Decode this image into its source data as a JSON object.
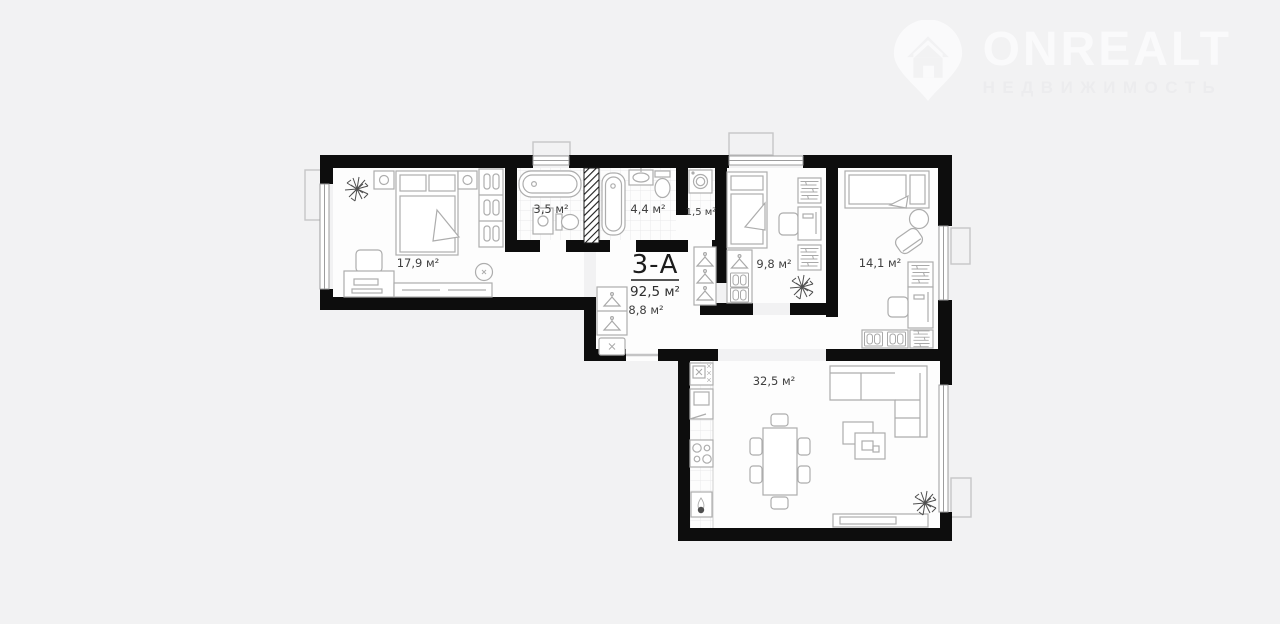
{
  "page": {
    "background": "#f2f2f3"
  },
  "logo": {
    "brand": "ONREALT",
    "tagline": "НЕДВИЖИМОСТЬ",
    "icon": "location-pin-house-icon",
    "color": "#fafafb"
  },
  "plan": {
    "unit": {
      "label": "3-А",
      "area": "92,5 м²"
    },
    "colors": {
      "wall": "#0d0d0d",
      "furniture_line": "#adadad",
      "floor": "#fdfdfd",
      "label_text": "#3f3f3f"
    },
    "rooms": [
      {
        "key": "bedroom-master",
        "area": "17,9 м²"
      },
      {
        "key": "bathroom-small",
        "area": "3,5 м²"
      },
      {
        "key": "bathroom-large",
        "area": "4,4 м²"
      },
      {
        "key": "laundry",
        "area": "1,5 м²"
      },
      {
        "key": "bedroom-kids",
        "area": "9,8 м²"
      },
      {
        "key": "bedroom-second",
        "area": "14,1 м²"
      },
      {
        "key": "hallway",
        "area": "8,8 м²"
      },
      {
        "key": "living-kitchen",
        "area": "32,5 м²"
      }
    ]
  }
}
